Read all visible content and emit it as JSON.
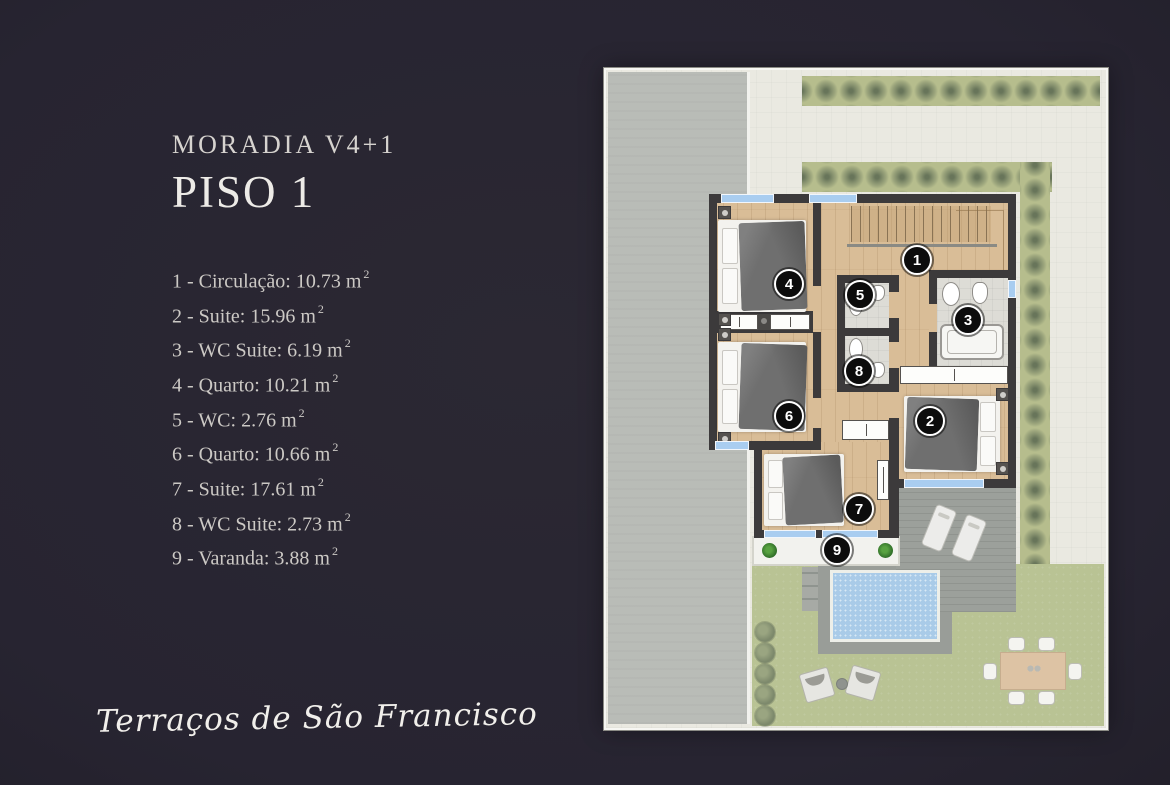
{
  "page": {
    "background": "#272431",
    "signature": "Terraços de São Francisco"
  },
  "header": {
    "title": "MORADIA V4+1",
    "subtitle": "PISO 1"
  },
  "legend": {
    "sup": "2",
    "items": [
      {
        "text": "1 - Circulação: 10.73 m"
      },
      {
        "text": "2 - Suite: 15.96 m"
      },
      {
        "text": "3 - WC Suite: 6.19 m"
      },
      {
        "text": "4 - Quarto: 10.21 m"
      },
      {
        "text": "5 - WC: 2.76 m"
      },
      {
        "text": "6 - Quarto: 10.66 m"
      },
      {
        "text": "7 - Suite: 17.61 m"
      },
      {
        "text": "8 - WC Suite: 2.73 m"
      },
      {
        "text": "9 - Varanda: 3.88 m"
      }
    ]
  },
  "floorplan": {
    "badges": [
      {
        "num": "1",
        "room": "Circulação"
      },
      {
        "num": "2",
        "room": "Suite"
      },
      {
        "num": "3",
        "room": "WC Suite"
      },
      {
        "num": "4",
        "room": "Quarto"
      },
      {
        "num": "5",
        "room": "WC"
      },
      {
        "num": "6",
        "room": "Quarto"
      },
      {
        "num": "7",
        "room": "Suite"
      },
      {
        "num": "8",
        "room": "WC Suite"
      },
      {
        "num": "9",
        "room": "Varanda"
      }
    ],
    "colors": {
      "wall": "#3c3a3b",
      "wood_floor": "#d9bd97",
      "tile_floor": "#dddcd6",
      "patio": "#eae9e1",
      "driveway": "#b9bcb7",
      "hedge": "#b6bd8d",
      "lawn": "#b9c394",
      "deck": "#9ca09b",
      "pool_water": "#a9cbe8",
      "window": "#a9cdf0"
    }
  }
}
